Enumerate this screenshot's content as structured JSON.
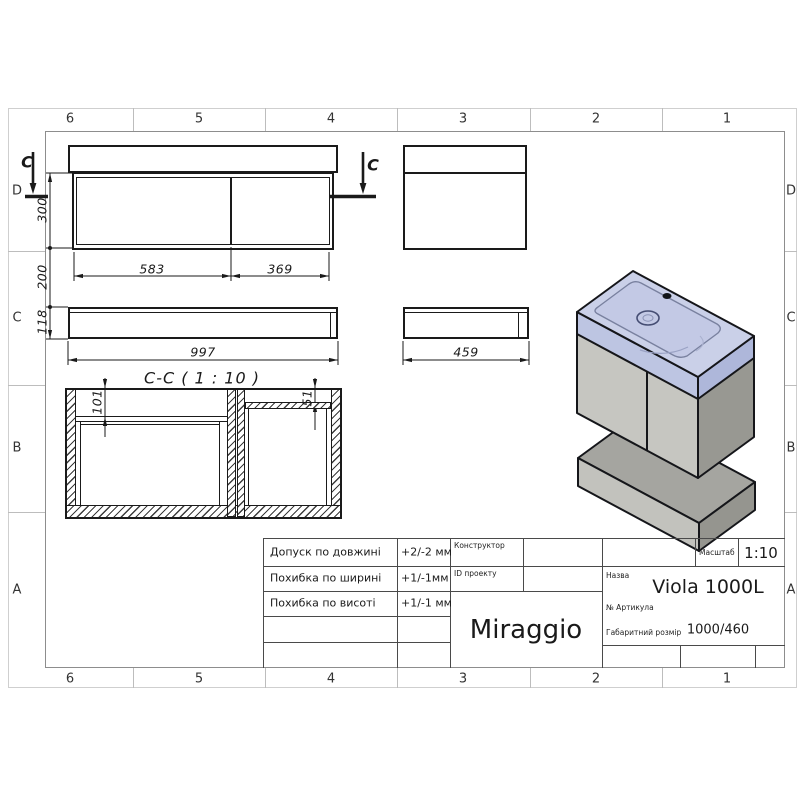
{
  "sheet": {
    "zone_columns": [
      "6",
      "5",
      "4",
      "3",
      "2",
      "1"
    ],
    "zone_rows": [
      "D",
      "C",
      "B",
      "A"
    ]
  },
  "views": {
    "section_title": "C-C ( 1 : 10 )",
    "cut_mark": "C",
    "dimensions": {
      "door_left_width": "583",
      "door_right_width": "369",
      "cabinet_height": "300",
      "wall_gap": "200",
      "shelf_height": "118",
      "cabinet_width": "997",
      "cabinet_depth": "459",
      "section_left_inset": "101",
      "section_right_inset": "51"
    }
  },
  "title_block": {
    "tolerances": [
      {
        "label": "Допуск по довжині",
        "value": "+2/-2 мм"
      },
      {
        "label": "Похибка по ширині",
        "value": "+1/-1мм"
      },
      {
        "label": "Похибка по висоті",
        "value": "+1/-1 мм"
      }
    ],
    "designer_label": "Конструктор",
    "project_id_label": "ID проекту",
    "brand": "Miraggio",
    "scale_label": "Масштаб",
    "scale_value": "1:10",
    "name_label": "Назва",
    "name_value": "Viola 1000L",
    "article_label": "№  Артикула",
    "overall_size_label": "Габаритний розмір",
    "overall_size_value": "1000/460"
  },
  "colors": {
    "sink_top": "#cad0e8",
    "sink_front": "#bdc5e2",
    "sink_side": "#aeb7da",
    "cabinet_front": "#c6c6c1",
    "cabinet_side": "#989892",
    "shelf_top": "#a5a5a0",
    "shelf_front": "#c2c2bd",
    "shelf_side": "#95958f",
    "line": "#1a1a1a"
  }
}
